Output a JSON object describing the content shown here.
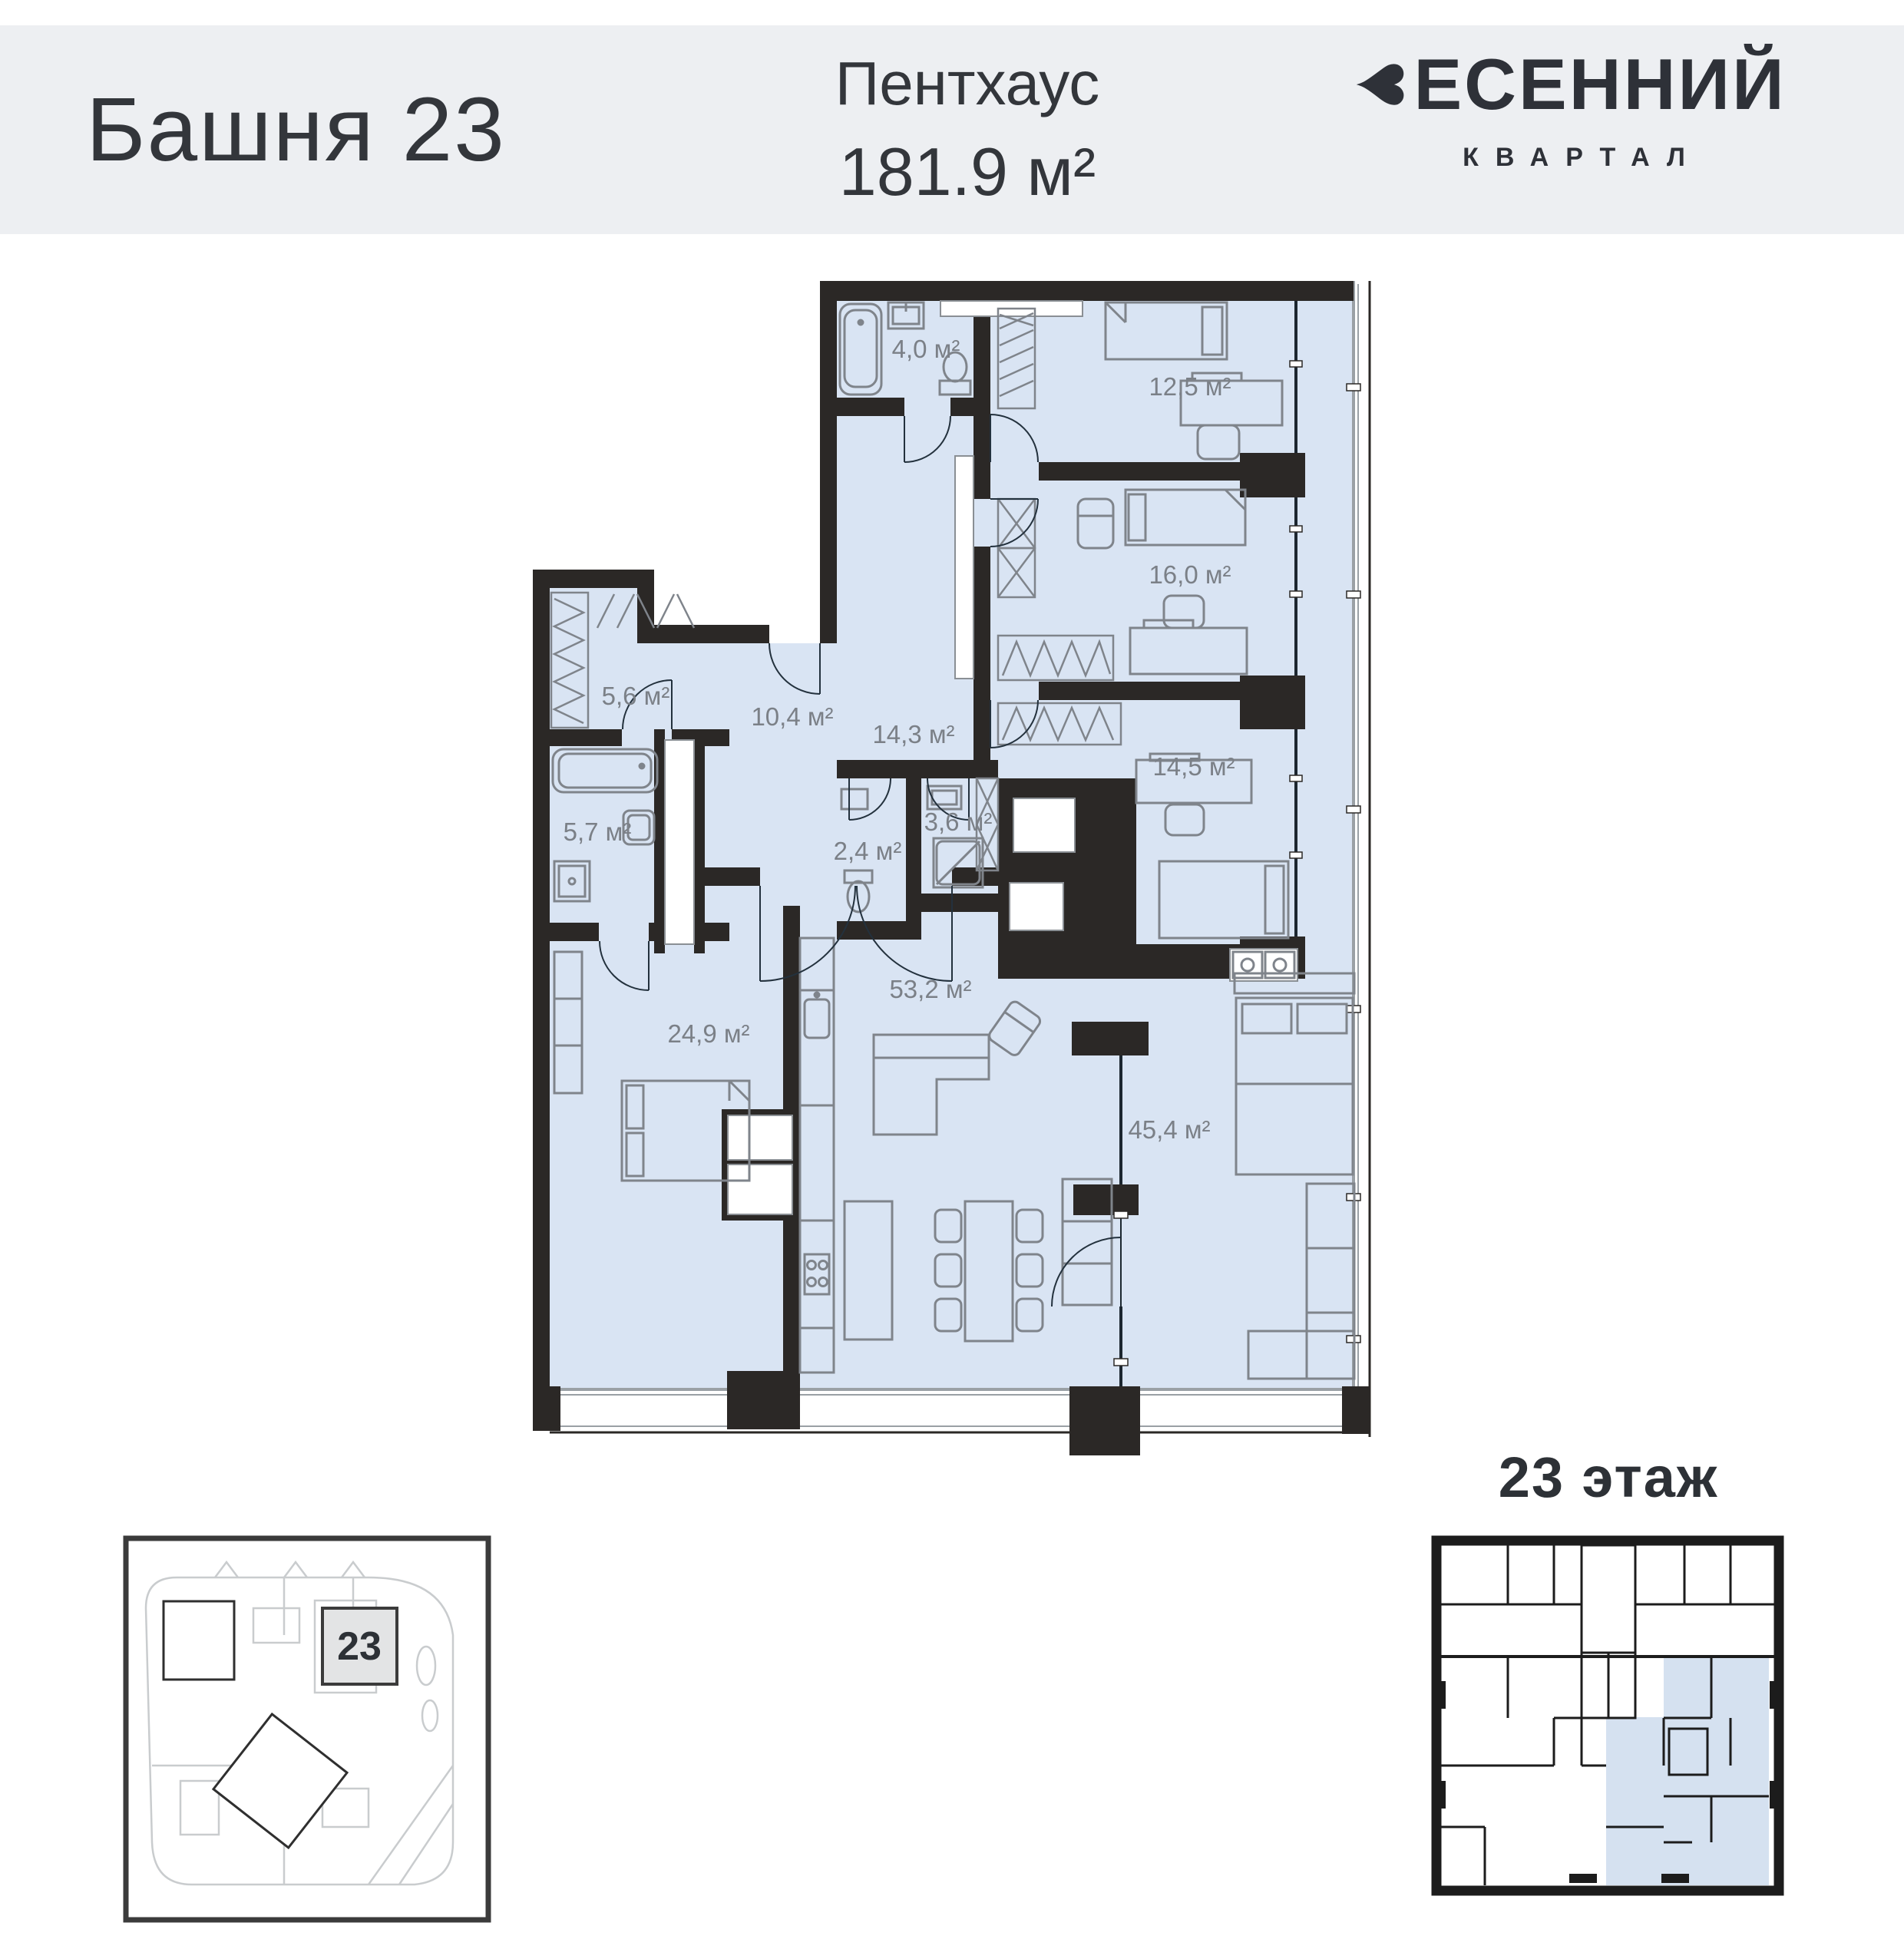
{
  "header": {
    "tower": "Башня 23",
    "unit_type": "Пентхаус",
    "unit_area": "181.9 м²",
    "brand_line1": "ВЕСЕННИЙ",
    "brand_line2": "КВАРТАЛ"
  },
  "plan": {
    "rooms": [
      {
        "area": "4,0 м²"
      },
      {
        "area": "12,5 м²"
      },
      {
        "area": "16,0 м²"
      },
      {
        "area": "14,5 м²"
      },
      {
        "area": "5,6 м²"
      },
      {
        "area": "10,4 м²"
      },
      {
        "area": "14,3 м²"
      },
      {
        "area": "5,7 м²"
      },
      {
        "area": "2,4 м²"
      },
      {
        "area": "3,6 м²"
      },
      {
        "area": "24,9 м²"
      },
      {
        "area": "53,2 м²"
      },
      {
        "area": "45,4 м²"
      }
    ]
  },
  "floor_plate": {
    "title": "23 этаж"
  },
  "site_plan": {
    "tower_number": "23"
  },
  "colors": {
    "header_bg": "#edeff2",
    "text_dark": "#33363b",
    "plan_fill": "#d9e4f3",
    "wall": "#2b2826",
    "furniture_stroke": "#7f848b",
    "label": "#7b8087",
    "highlight_fill": "#d5e1f0"
  }
}
